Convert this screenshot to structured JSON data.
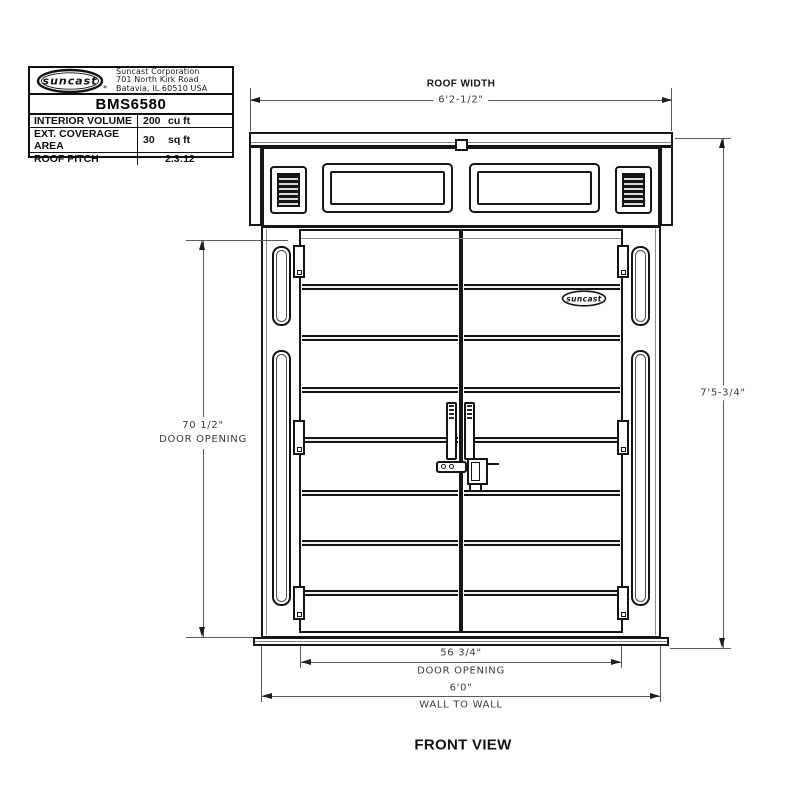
{
  "title_block": {
    "logo": {
      "text": "suncast",
      "mark": "*"
    },
    "company_lines": [
      "Suncast Corporation",
      "701 North Kirk Road",
      "Batavia, IL 60510 USA"
    ],
    "model": "BMS6580",
    "specs": [
      {
        "label": "INTERIOR VOLUME",
        "value": "200",
        "unit": "cu ft"
      },
      {
        "label": "EXT. COVERAGE AREA",
        "value": "30",
        "unit": "sq ft"
      },
      {
        "label": "ROOF PITCH",
        "value": "2.3:12",
        "unit": ""
      }
    ]
  },
  "annotations": {
    "roof_width": {
      "title": "ROOF WIDTH",
      "value": "6'2-1/2\""
    },
    "overall_height": {
      "value": "7'5-3/4\""
    },
    "door_opening_height": {
      "value": "70 1/2\"",
      "label": "DOOR OPENING"
    },
    "door_opening_width": {
      "value": "56 3/4\"",
      "label": "DOOR OPENING"
    },
    "wall_to_wall": {
      "value": "6'0\"",
      "label": "WALL TO WALL"
    }
  },
  "door_logo_text": "suncast",
  "view_label": "FRONT VIEW"
}
